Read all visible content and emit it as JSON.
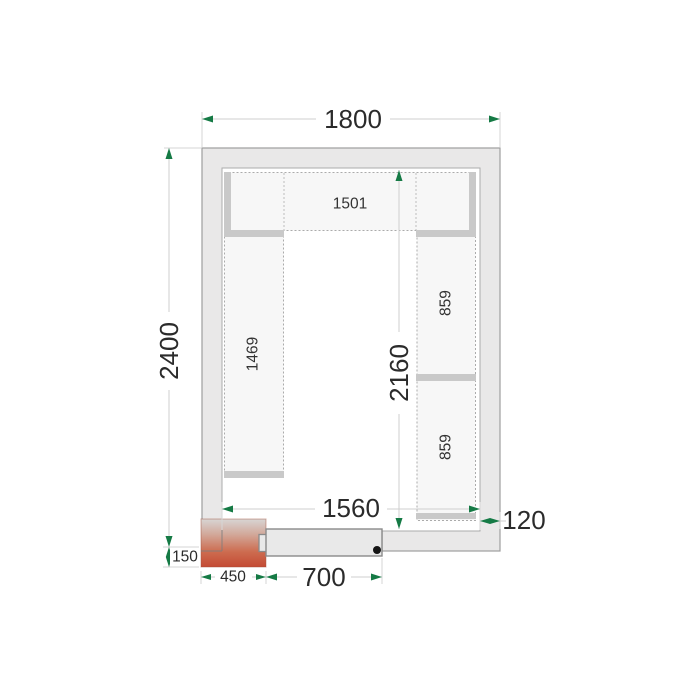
{
  "diagram": {
    "type": "cold-room-floor-plan",
    "dims": {
      "outer_width": "1800",
      "outer_height": "2400",
      "inner_width": "1560",
      "inner_height": "2160",
      "wall_thickness": "120",
      "door_width": "700",
      "unit_width": "450",
      "unit_depth": "150"
    },
    "shelves": {
      "top": "1501",
      "left": "1469",
      "right_upper": "859",
      "right_lower": "859"
    },
    "colors": {
      "wall_fill": "#e9e8e8",
      "wall_border": "#9e9e9e",
      "shelf_fill": "#f7f7f7",
      "shelf_bar": "#c9c9c9",
      "dim_line": "#cfcfcf",
      "arrow_green": "#157a45",
      "unit_red_bottom": "#c44a33",
      "unit_gray_top": "#d8d5d4",
      "door_fill": "#e9e9e9",
      "text": "#2b2b2b"
    }
  }
}
